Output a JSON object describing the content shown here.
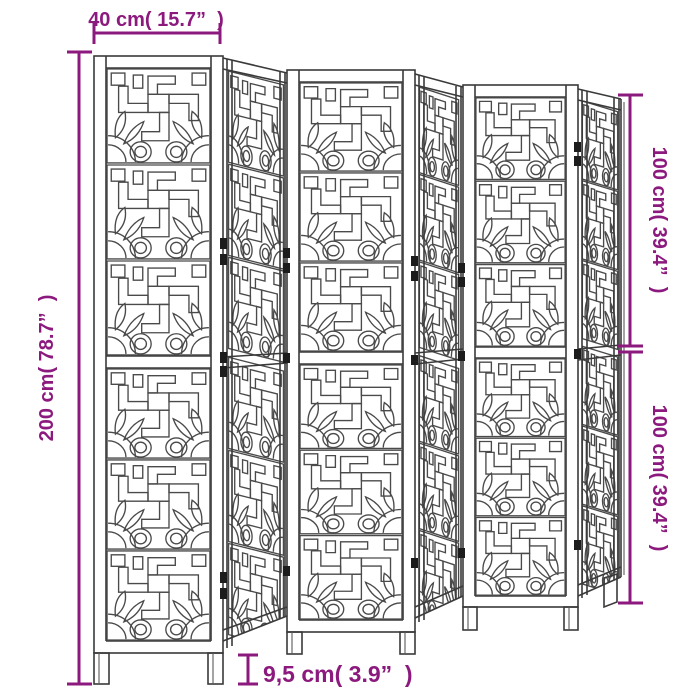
{
  "title": "Room divider dimension diagram",
  "product": {
    "type": "folding room divider with fretwork panels",
    "panel_count": 6,
    "drawing_style": "black line-art perspective"
  },
  "colors": {
    "dimension_accent": "#8C1A7E",
    "line_art": "#3A3A3A",
    "background": "#FFFFFF"
  },
  "dimensions": {
    "panel_width": {
      "label": "40 cm( 15.7”  )",
      "position": "top"
    },
    "total_height": {
      "label": "200 cm( 78.7”  )",
      "position": "left"
    },
    "upper_height": {
      "label": "100 cm( 39.4”  )",
      "position": "right-top"
    },
    "lower_height": {
      "label": "100 cm( 39.4”  )",
      "position": "right-bottom"
    },
    "leg_height": {
      "label": "9,5 cm( 3.9”  )",
      "position": "bottom"
    }
  }
}
